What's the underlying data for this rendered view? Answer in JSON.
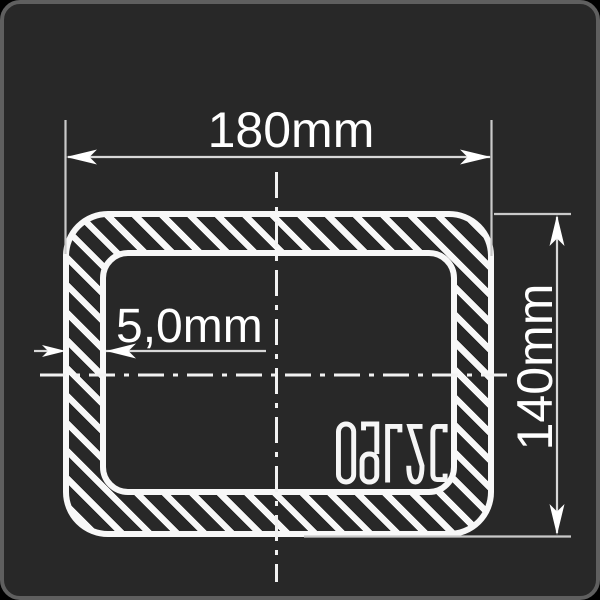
{
  "drawing": {
    "dimensions": {
      "width_label": "180mm",
      "height_label": "140mm",
      "wall_thickness_label": "5,0mm"
    },
    "steel_grade": "09Г2С",
    "colors": {
      "background": "#282828",
      "panel_border": "#5f5f5f",
      "outline_white": "#f8f8f8",
      "dimension_gray": "#c9c9c9"
    }
  }
}
